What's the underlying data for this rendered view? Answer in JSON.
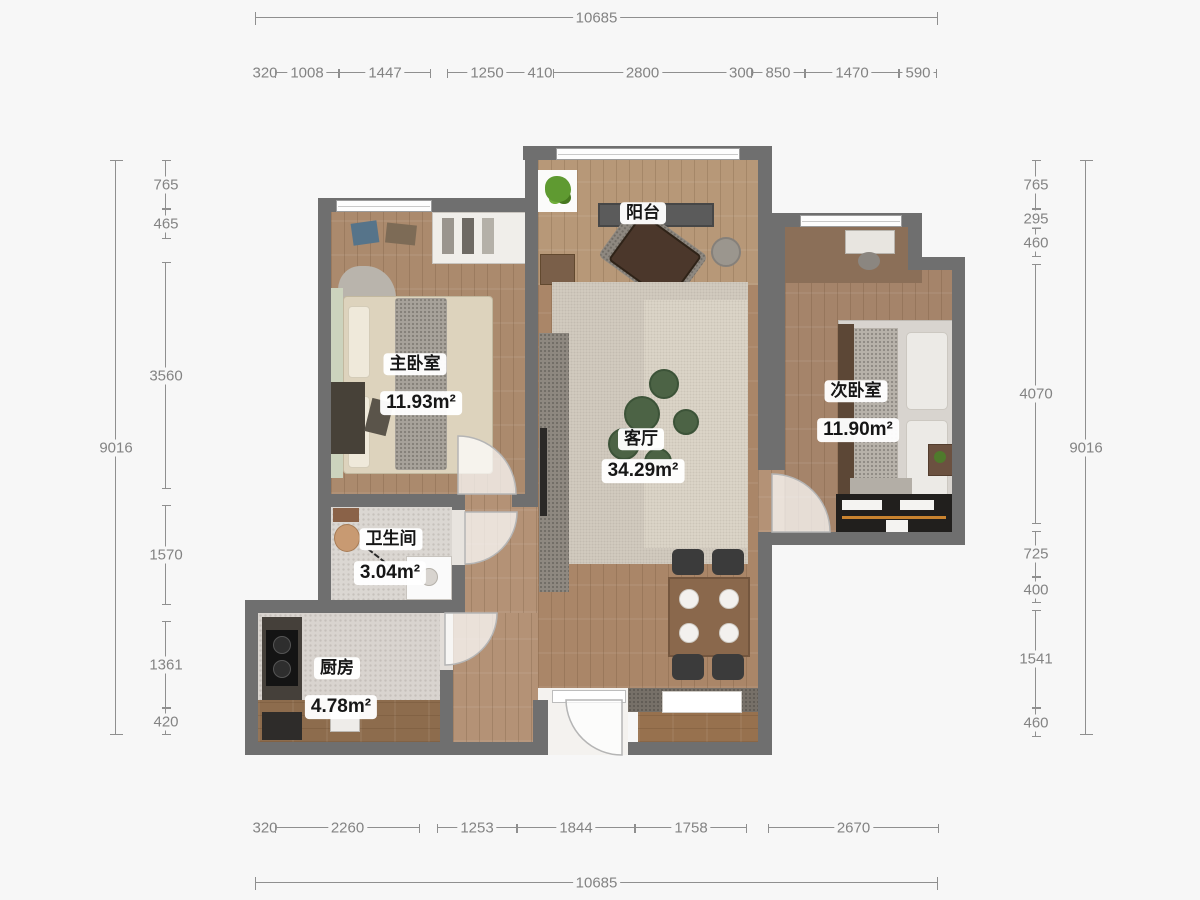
{
  "page": {
    "background": "#f7f7f7",
    "wall_color": "#6f6f6f",
    "dimension_color": "#838383"
  },
  "rooms": {
    "master": {
      "name": "主卧室",
      "area": "11.93m²"
    },
    "living": {
      "name": "客厅",
      "area": "34.29m²"
    },
    "second": {
      "name": "次卧室",
      "area": "11.90m²"
    },
    "bath": {
      "name": "卫生间",
      "area": "3.04m²"
    },
    "kitchen": {
      "name": "厨房",
      "area": "4.78m²"
    },
    "balcony": {
      "name": "阳台"
    }
  },
  "rulers": [
    {
      "id": "dim-top-overall",
      "orient": "h",
      "pos": 17,
      "tick": 13,
      "segments": [
        {
          "label": "10685",
          "from": 255,
          "to": 938
        }
      ]
    },
    {
      "id": "dim-top-segments",
      "orient": "h",
      "pos": 72,
      "tick": 9,
      "segments": [
        {
          "label": "320",
          "from": 255,
          "to": 275
        },
        {
          "label": "1008",
          "from": 275,
          "to": 339
        },
        {
          "label": "1447",
          "from": 339,
          "to": 431
        },
        {
          "label": "1250",
          "from": 447,
          "to": 527
        },
        {
          "label": "410",
          "from": 527,
          "to": 553
        },
        {
          "label": "2800",
          "from": 553,
          "to": 732
        },
        {
          "label": "300",
          "from": 732,
          "to": 751
        },
        {
          "label": "850",
          "from": 751,
          "to": 805
        },
        {
          "label": "1470",
          "from": 805,
          "to": 899
        },
        {
          "label": "590",
          "from": 899,
          "to": 937
        }
      ]
    },
    {
      "id": "dim-left-overall",
      "orient": "v",
      "pos": 115,
      "tick": 13,
      "segments": [
        {
          "label": "9016",
          "from": 160,
          "to": 735
        }
      ]
    },
    {
      "id": "dim-left-segments",
      "orient": "v",
      "pos": 165,
      "tick": 9,
      "segments": [
        {
          "label": "765",
          "from": 160,
          "to": 209
        },
        {
          "label": "465",
          "from": 209,
          "to": 239
        },
        {
          "label": "3560",
          "from": 262,
          "to": 489
        },
        {
          "label": "1570",
          "from": 505,
          "to": 605
        },
        {
          "label": "1361",
          "from": 621,
          "to": 708
        },
        {
          "label": "420",
          "from": 708,
          "to": 735
        }
      ]
    },
    {
      "id": "dim-right-segments",
      "orient": "v",
      "pos": 1035,
      "tick": 9,
      "segments": [
        {
          "label": "765",
          "from": 160,
          "to": 209
        },
        {
          "label": "295",
          "from": 209,
          "to": 228
        },
        {
          "label": "460",
          "from": 228,
          "to": 257
        },
        {
          "label": "4070",
          "from": 264,
          "to": 524
        },
        {
          "label": "725",
          "from": 531,
          "to": 577
        },
        {
          "label": "400",
          "from": 577,
          "to": 603
        },
        {
          "label": "1541",
          "from": 610,
          "to": 708
        },
        {
          "label": "460",
          "from": 708,
          "to": 737
        }
      ]
    },
    {
      "id": "dim-right-overall",
      "orient": "v",
      "pos": 1085,
      "tick": 13,
      "segments": [
        {
          "label": "9016",
          "from": 160,
          "to": 735
        }
      ]
    },
    {
      "id": "dim-bottom-segments",
      "orient": "h",
      "pos": 827,
      "tick": 9,
      "segments": [
        {
          "label": "320",
          "from": 255,
          "to": 275
        },
        {
          "label": "2260",
          "from": 275,
          "to": 420
        },
        {
          "label": "1253",
          "from": 437,
          "to": 517
        },
        {
          "label": "1844",
          "from": 517,
          "to": 635
        },
        {
          "label": "1758",
          "from": 635,
          "to": 747
        },
        {
          "label": "2670",
          "from": 768,
          "to": 939
        }
      ]
    },
    {
      "id": "dim-bottom-overall",
      "orient": "h",
      "pos": 882,
      "tick": 13,
      "segments": [
        {
          "label": "10685",
          "from": 255,
          "to": 938
        }
      ]
    }
  ]
}
